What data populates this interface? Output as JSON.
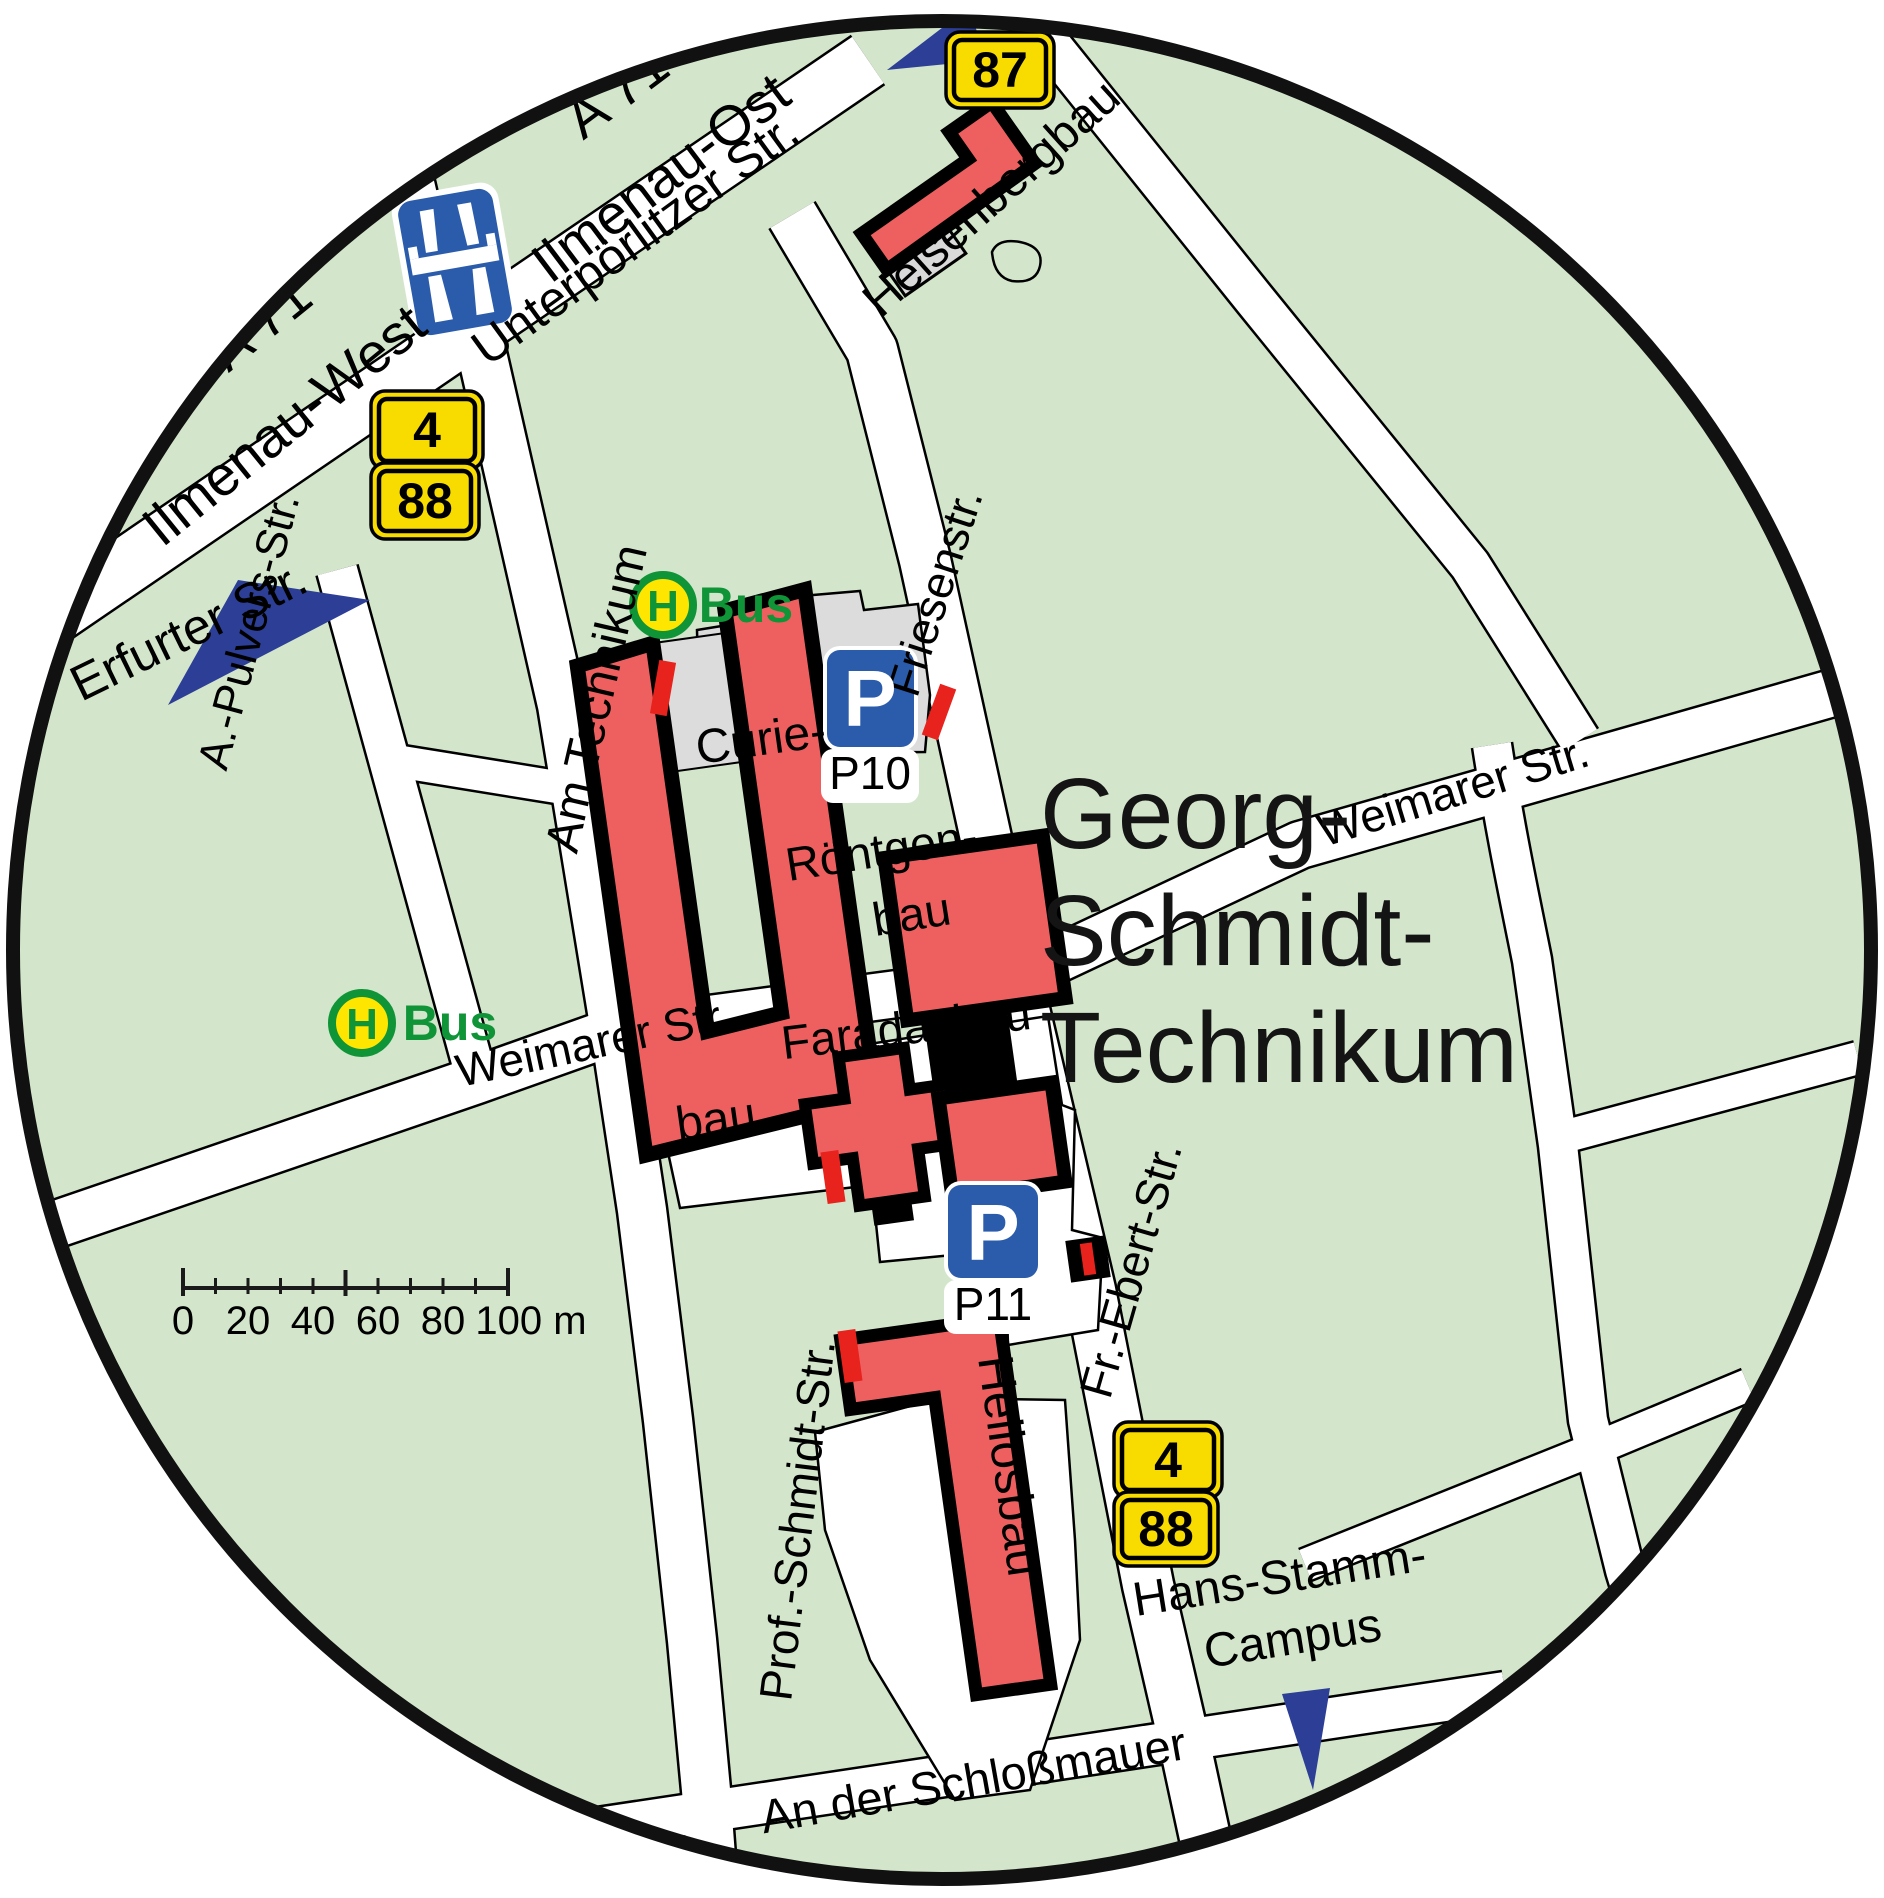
{
  "map": {
    "region_title": [
      "Georg-",
      "Schmidt-",
      "Technikum"
    ],
    "colors": {
      "land": "#d3e6cb",
      "road": "#ffffff",
      "building_red": "#ee6060",
      "parking_gray": "#dcdcdc",
      "bus_green": "#0f9437",
      "bus_yellow": "#ffe600",
      "badge_yellow": "#f8dc00",
      "parking_blue": "#2b5cab",
      "arrow_blue": "#2c3e95",
      "tick_red": "#e8221c",
      "ring_black": "#111111"
    },
    "labels": [
      {
        "name": "label-a71-north",
        "text": "A 71",
        "x": 628,
        "y": 107,
        "rot": -37,
        "size": 56,
        "cls": "lbl",
        "anchor": "middle",
        "weight": 400
      },
      {
        "name": "label-ilmenau-ost",
        "text": "Ilmenau-Ost",
        "x": 672,
        "y": 193,
        "rot": -37,
        "size": 56,
        "cls": "lbl",
        "anchor": "middle",
        "weight": 400
      },
      {
        "name": "label-a71-west",
        "text": "A 71",
        "x": 272,
        "y": 338,
        "rot": -39,
        "size": 56,
        "cls": "lbl",
        "anchor": "middle",
        "weight": 400
      },
      {
        "name": "label-ilmenau-west",
        "text": "Ilmenau-West",
        "x": 296,
        "y": 440,
        "rot": -39,
        "size": 56,
        "cls": "lbl",
        "anchor": "middle",
        "weight": 400
      },
      {
        "name": "label-unterpoerlitzer-str",
        "text": "Unterpörlitzer Str.",
        "x": 645,
        "y": 253,
        "rot": -36,
        "size": 50,
        "cls": "lbl",
        "anchor": "middle",
        "weight": 400
      },
      {
        "name": "label-erfurter-str",
        "text": "Erfurter Str.",
        "x": 196,
        "y": 646,
        "rot": -26,
        "size": 50,
        "cls": "lbl",
        "anchor": "middle",
        "weight": 400
      },
      {
        "name": "label-a-pulvers-str",
        "text": "A.-Pulvers-Str.",
        "x": 263,
        "y": 635,
        "rot": -75,
        "size": 44,
        "cls": "lbl",
        "anchor": "middle",
        "weight": 400
      },
      {
        "name": "label-am-technikum",
        "text": "Am Technikum",
        "x": 612,
        "y": 702,
        "rot": -77,
        "size": 48,
        "cls": "lbl",
        "anchor": "middle",
        "weight": 400
      },
      {
        "name": "label-friesenstr",
        "text": "Friesenstr.",
        "x": 950,
        "y": 597,
        "rot": -72,
        "size": 46,
        "cls": "lbl",
        "anchor": "middle",
        "weight": 400
      },
      {
        "name": "label-heisenbergbau",
        "text": "Heisenbergbau",
        "x": 1002,
        "y": 210,
        "rot": -42,
        "size": 48,
        "cls": "lbl",
        "anchor": "middle",
        "weight": 400
      },
      {
        "name": "label-weimarer-str-west",
        "text": "Weimarer Str.",
        "x": 597,
        "y": 1058,
        "rot": -12,
        "size": 46,
        "cls": "lbl",
        "anchor": "middle",
        "weight": 400
      },
      {
        "name": "label-weimarer-str-east",
        "text": "Weimarer Str.",
        "x": 1458,
        "y": 806,
        "rot": -17,
        "size": 46,
        "cls": "lbl",
        "anchor": "middle",
        "weight": 400
      },
      {
        "name": "title-line-1",
        "text": "Georg-",
        "x": 1040,
        "y": 848,
        "rot": 0,
        "size": 100,
        "cls": "lbl lbl-title",
        "anchor": "start",
        "weight": 400
      },
      {
        "name": "title-line-2",
        "text": "Schmidt-",
        "x": 1040,
        "y": 965,
        "rot": 0,
        "size": 100,
        "cls": "lbl lbl-title",
        "anchor": "start",
        "weight": 400
      },
      {
        "name": "title-line-3",
        "text": "Technikum",
        "x": 1040,
        "y": 1082,
        "rot": 0,
        "size": 100,
        "cls": "lbl lbl-title",
        "anchor": "start",
        "weight": 400
      },
      {
        "name": "label-curiebau-1",
        "text": "Curie-",
        "x": 763,
        "y": 755,
        "rot": -8,
        "size": 48,
        "cls": "lbl",
        "anchor": "middle",
        "weight": 400
      },
      {
        "name": "label-curiebau-2",
        "text": "bau",
        "x": 718,
        "y": 1135,
        "rot": -8,
        "size": 48,
        "cls": "lbl",
        "anchor": "middle",
        "weight": 400
      },
      {
        "name": "label-roentgenbau-1",
        "text": "Röntgen-",
        "x": 884,
        "y": 866,
        "rot": -9,
        "size": 47,
        "cls": "lbl",
        "anchor": "middle",
        "weight": 400
      },
      {
        "name": "label-roentgenbau-2",
        "text": "bau",
        "x": 914,
        "y": 930,
        "rot": -9,
        "size": 47,
        "cls": "lbl",
        "anchor": "middle",
        "weight": 400
      },
      {
        "name": "label-faradaybau",
        "text": "Faradaybau",
        "x": 908,
        "y": 1044,
        "rot": -7,
        "size": 47,
        "cls": "lbl",
        "anchor": "middle",
        "weight": 400
      },
      {
        "name": "label-heliosbau",
        "text": "Heliosbau",
        "x": 978,
        "y": 1358,
        "rot": 82,
        "size": 50,
        "cls": "lbl",
        "anchor": "start",
        "weight": 400
      },
      {
        "name": "label-fr-ebert-str",
        "text": "Fr.-Ebert-Str.",
        "x": 1146,
        "y": 1274,
        "rot": -74,
        "size": 46,
        "cls": "lbl",
        "anchor": "middle",
        "weight": 400
      },
      {
        "name": "label-prof-schmidt-str",
        "text": "Prof.-Schmidt-Str.",
        "x": 813,
        "y": 1522,
        "rot": -83,
        "size": 46,
        "cls": "lbl",
        "anchor": "middle",
        "weight": 400
      },
      {
        "name": "label-an-der-schlossmauer",
        "text": "An der Schloßmauer",
        "x": 976,
        "y": 1796,
        "rot": -10,
        "size": 47,
        "cls": "lbl",
        "anchor": "middle",
        "weight": 400
      },
      {
        "name": "label-hans-stamm",
        "text": "Hans-Stamm-",
        "x": 1282,
        "y": 1593,
        "rot": -9,
        "size": 48,
        "cls": "lbl",
        "anchor": "middle",
        "weight": 400
      },
      {
        "name": "label-campus",
        "text": "Campus",
        "x": 1295,
        "y": 1654,
        "rot": -9,
        "size": 48,
        "cls": "lbl",
        "anchor": "middle",
        "weight": 400
      },
      {
        "name": "bus-stop-north-label",
        "text": "Bus",
        "x": 746,
        "y": 622,
        "rot": 0,
        "size": 50,
        "cls": "lbl lbl-green",
        "anchor": "middle",
        "weight": 700
      },
      {
        "name": "bus-stop-west-label",
        "text": "Bus",
        "x": 450,
        "y": 1040,
        "rot": 0,
        "size": 50,
        "cls": "lbl lbl-green",
        "anchor": "middle",
        "weight": 700
      },
      {
        "name": "bus-stop-north-h-icon",
        "text": "H",
        "x": 663,
        "y": 621,
        "rot": 0,
        "size": 44,
        "cls": "lbl lbl-green",
        "anchor": "middle",
        "weight": 700
      },
      {
        "name": "bus-stop-west-h-icon",
        "text": "H",
        "x": 362,
        "y": 1039,
        "rot": 0,
        "size": 44,
        "cls": "lbl lbl-green",
        "anchor": "middle",
        "weight": 700
      },
      {
        "name": "parking-p10-icon",
        "text": "P",
        "x": 870,
        "y": 726,
        "rot": 0,
        "size": 80,
        "cls": "lbl lbl-white",
        "anchor": "middle",
        "weight": 700
      },
      {
        "name": "parking-p11-icon",
        "text": "P",
        "x": 993,
        "y": 1260,
        "rot": 0,
        "size": 80,
        "cls": "lbl lbl-white",
        "anchor": "middle",
        "weight": 700
      },
      {
        "name": "parking-p10-label",
        "text": "P10",
        "x": 870,
        "y": 789,
        "rot": 0,
        "size": 46,
        "cls": "lbl",
        "anchor": "middle",
        "weight": 400
      },
      {
        "name": "parking-p11-label",
        "text": "P11",
        "x": 993,
        "y": 1320,
        "rot": 0,
        "size": 46,
        "cls": "lbl",
        "anchor": "middle",
        "weight": 400
      }
    ],
    "badges": [
      {
        "name": "route-badge-4-north",
        "text": "4",
        "cx": 427,
        "cy": 430,
        "w": 96,
        "h": 62
      },
      {
        "name": "route-badge-88-north",
        "text": "88",
        "cx": 425,
        "cy": 501,
        "w": 92,
        "h": 60
      },
      {
        "name": "route-badge-87",
        "text": "87",
        "cx": 1000,
        "cy": 70,
        "w": 92,
        "h": 60
      },
      {
        "name": "route-badge-4-south",
        "text": "4",
        "cx": 1168,
        "cy": 1460,
        "w": 92,
        "h": 60
      },
      {
        "name": "route-badge-88-south",
        "text": "88",
        "cx": 1166,
        "cy": 1529,
        "w": 88,
        "h": 58
      }
    ],
    "bus_stops": [
      {
        "name": "bus-stop-north",
        "cx": 663,
        "cy": 605,
        "r": 30
      },
      {
        "name": "bus-stop-west",
        "cx": 362,
        "cy": 1023,
        "r": 30
      }
    ],
    "parking_signs": [
      {
        "name": "parking-sign-p10",
        "sx": 827,
        "sy": 650,
        "sw": 87,
        "sh": 97,
        "bx": 821,
        "by": 749,
        "bw": 98,
        "bh": 54
      },
      {
        "name": "parking-sign-p11",
        "sx": 948,
        "sy": 1185,
        "sw": 90,
        "sh": 93,
        "bx": 944,
        "by": 1280,
        "bw": 98,
        "bh": 54
      }
    ],
    "scalebar": {
      "labels": [
        "0",
        "20",
        "40",
        "60",
        "80",
        "100 m"
      ],
      "xs": [
        183,
        248,
        313,
        378,
        443,
        531
      ],
      "y": 1334,
      "size": 40
    }
  }
}
